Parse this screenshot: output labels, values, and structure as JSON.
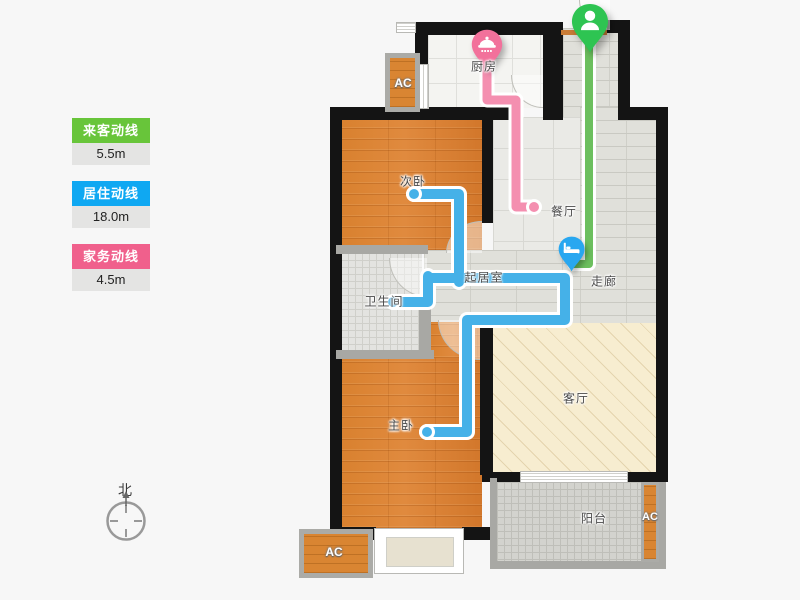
{
  "legend": {
    "items": [
      {
        "label": "来客动线",
        "value": "5.5m",
        "color": "#68C53A"
      },
      {
        "label": "居住动线",
        "value": "18.0m",
        "color": "#0FA8F2"
      },
      {
        "label": "家务动线",
        "value": "4.5m",
        "color": "#F0608C"
      }
    ]
  },
  "compass": {
    "label": "北"
  },
  "rooms": {
    "kitchen": {
      "label": "厨房"
    },
    "dining": {
      "label": "餐厅"
    },
    "hallway": {
      "label": "走廊"
    },
    "bedroom2": {
      "label": "次卧"
    },
    "core": {
      "label": "起居室"
    },
    "bathroom": {
      "label": "卫生间"
    },
    "master": {
      "label": "主卧"
    },
    "living": {
      "label": "客厅"
    },
    "balcony": {
      "label": "阳台"
    }
  },
  "ac_units": {
    "top": {
      "label": "AC"
    },
    "bottom": {
      "label": "AC"
    },
    "balcony": {
      "label": "AC"
    }
  },
  "paths": {
    "guest": {
      "name": "来客动线",
      "color": "#6CBF5E"
    },
    "resident": {
      "name": "居住动线",
      "color": "#45B1E8"
    },
    "chores": {
      "name": "家务动线",
      "color": "#F48FB0"
    }
  },
  "pins": {
    "entrance": {
      "type": "person",
      "color": "#2EC452"
    },
    "kitchen": {
      "type": "pot",
      "color": "#F2719B"
    },
    "bedroom": {
      "type": "bed",
      "color": "#28A7F0"
    }
  }
}
